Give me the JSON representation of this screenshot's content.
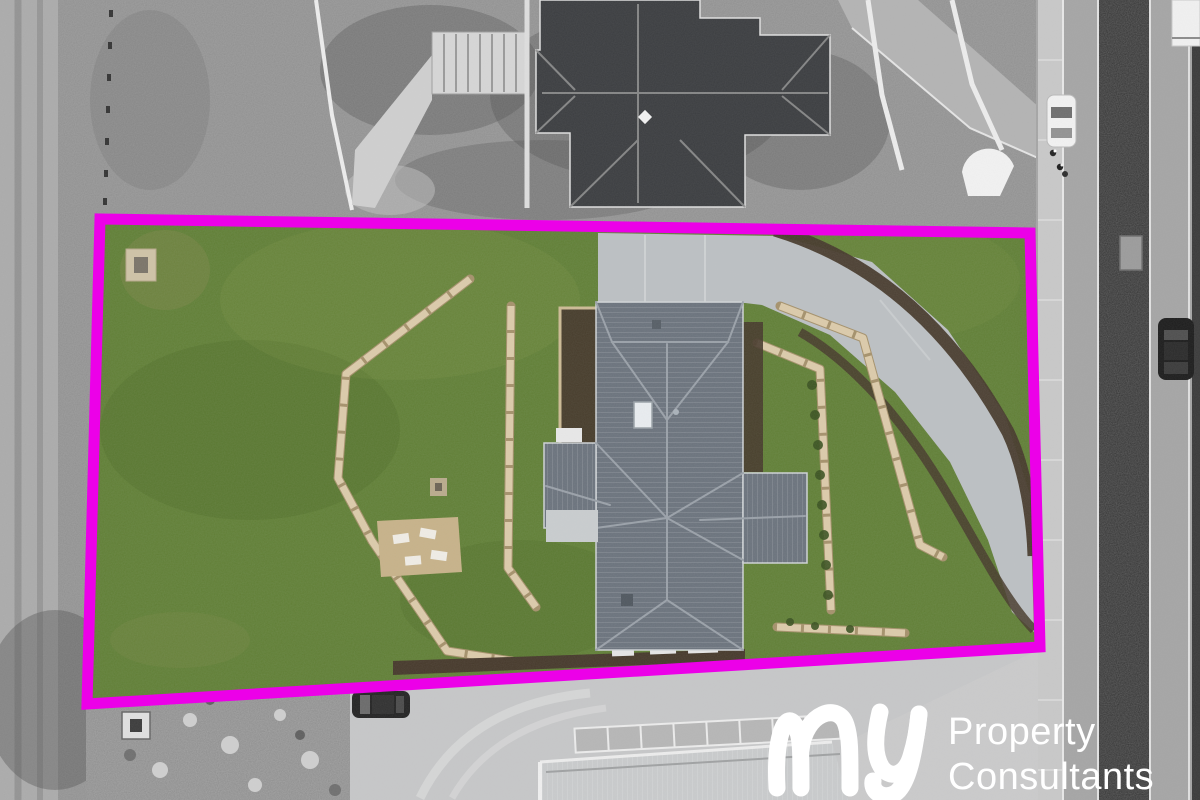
{
  "watermark": {
    "script": "my",
    "line1": "Property",
    "line2": "Consultants",
    "text_color": "#ffffff"
  },
  "boundary": {
    "color": "#ec00e8",
    "stroke_px": 11,
    "shape": "quadrilateral lot outline",
    "corners": [
      [
        100,
        219
      ],
      [
        1030,
        233
      ],
      [
        1040,
        647
      ],
      [
        87,
        704
      ]
    ]
  },
  "scene": {
    "type": "aerial-drone-photo",
    "inside_boundary": "full color",
    "outside_boundary": "grayscale",
    "objects": [
      "lot-lawn",
      "cross-shaped-slate-roof-house",
      "curved-concrete-driveway",
      "timber-sleeper-retaining-walls",
      "gravel-patio-with-timber-benches",
      "garden-mulch-beds",
      "neighbor-house-dark-roof",
      "entry-stairs",
      "street-with-planted-median",
      "footpath",
      "white-car",
      "dark-suv",
      "white-van",
      "pedestrians",
      "rock-pile",
      "utility-pit",
      "parked-dark-car",
      "shed-roof-under-construction",
      "timber-wall-frames",
      "skylight",
      "roof-vents"
    ]
  },
  "palette": {
    "boundary": "#ec00e8",
    "bg": "#8f8f8f",
    "grass": "#5e7c31",
    "roof": "#6b737d",
    "ridge": "#9aa1a9",
    "concrete": "#bcc0c3",
    "concOut": "#c6c7c8",
    "mulch": "#46392b",
    "sleeper": "#dccbaa",
    "sleeperDark": "#a5916b",
    "patio": "#c7b289",
    "darkroof": "#3b3d40",
    "asphalt": "#a5a5a5",
    "median": "#2d2d2d",
    "footpath": "#c8c8c8",
    "white": "#ffffff",
    "bush": "#3a5220"
  }
}
